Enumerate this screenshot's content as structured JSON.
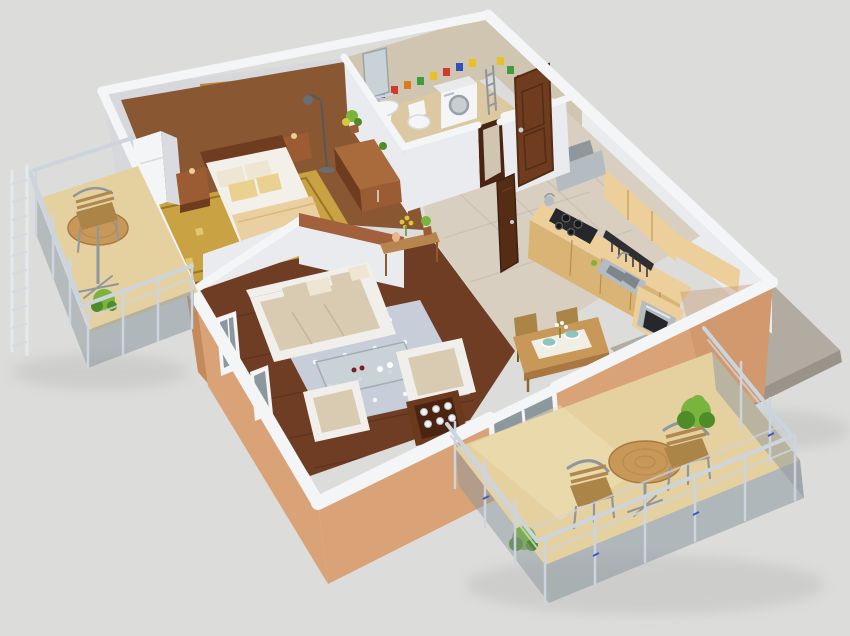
{
  "scene": {
    "type": "3d-floorplan-render",
    "view": "isometric-cutaway-apartment",
    "rooms": [
      {
        "name": "bedroom",
        "furniture": [
          "double-bed",
          "two-nightstands",
          "table-lamp",
          "floor-lamp",
          "wooden-wardrobe",
          "built-in-closet",
          "landscape-painting",
          "ornamental-gold-rug",
          "potted-plant"
        ]
      },
      {
        "name": "bathroom",
        "furniture": [
          "washbasin-with-pedestal",
          "mirror",
          "shelf",
          "toilet",
          "washing-machine",
          "towel-ladder",
          "mosaic-tile-border"
        ]
      },
      {
        "name": "hall",
        "furniture": [
          "entrance-door",
          "open-bathroom-door",
          "tile-floor"
        ]
      },
      {
        "name": "kitchen",
        "furniture": [
          "base-cabinets",
          "wall-cabinets",
          "gas-hob",
          "kettle",
          "extractor-hood",
          "double-sink",
          "utensil-rail",
          "built-in-oven",
          "counter-extension"
        ]
      },
      {
        "name": "living-room",
        "furniture": [
          "three-seat-sofa",
          "throw-pillows",
          "glass-coffee-table",
          "two-armchairs",
          "polka-dot-rug",
          "console-table",
          "flower-pots",
          "sideboard-with-glasses"
        ]
      },
      {
        "name": "dining-area",
        "furniture": [
          "dining-table",
          "table-runner",
          "two-chairs",
          "bowls",
          "flower-vase"
        ]
      },
      {
        "name": "left-balcony",
        "furniture": [
          "round-bistro-table",
          "slatted-chair",
          "potted-plant",
          "glass-metal-railing"
        ]
      },
      {
        "name": "right-balcony",
        "furniture": [
          "round-bistro-table",
          "two-slatted-chairs",
          "green-shrubs",
          "glass-metal-railing",
          "balcony-window-door"
        ]
      }
    ]
  },
  "colors": {
    "background": "#dcdddb",
    "concrete": "#b2aba2",
    "concrete_dark": "#9a9389",
    "wall_cap": "#f4f5f7",
    "wall_light": "#e9ebee",
    "wall_mid": "#d9dbe0",
    "wall_back": "#d7d8dc",
    "salmon": "#d9a277",
    "salmon_light": "#e6bd92",
    "salmon_dark": "#c48a5c",
    "bath_wall": "#cfc5b0",
    "bath_floor": "#dcc9a2",
    "tile": "#d8cfc0",
    "tile_line": "#b4aa97",
    "wood_dark": "#6e3d23",
    "wood_line": "#4f2a13",
    "bed_floor": "#8a5733",
    "rug_gold": "#c9a244",
    "rug_gold_dark": "#8d6c1d",
    "rug_blue": "#c7ced9",
    "white_soft": "#f0efec",
    "cushion": "#d9cbb2",
    "pillow_cream": "#eee6d3",
    "pillow_gold": "#ebd190",
    "linen": "#f3f0ea",
    "blanket": "#eacfa0",
    "brown": "#9b5c33",
    "brown_dark": "#6f3c1f",
    "brown_deep": "#4a2410",
    "door": "#6f3c1f",
    "door_dark": "#552c14",
    "kitchen_wood": "#eccf9a",
    "kitchen_wood_dark": "#d9b475",
    "steel": "#b4bcc2",
    "steel_dark": "#8f979e",
    "appliance_black": "#26272b",
    "fixture_white": "#f4f5f6",
    "rail": "#ccd4de",
    "rail_dark": "#9aa4b0",
    "glass": "#8d979e",
    "balcony": "#e5d1a0",
    "balcony_light": "#f0e2b4",
    "green": "#79b43d",
    "green_dark": "#4e8c28",
    "accent_blue": "#3e58c8",
    "brick": "#a2603c",
    "glass_table": "#c9d3d7",
    "mosaic_red": "#cf3a30",
    "mosaic_yellow": "#e8c224",
    "mosaic_green": "#3f9b3f",
    "mosaic_blue": "#2d52c0",
    "mosaic_orange": "#e07820",
    "painting_sky": "#6f9fd8",
    "painting_cloud": "#f3f6f9",
    "painting_field": "#5f9140",
    "painting_frame": "#b5883f",
    "teal": "#8fc3bd",
    "wood_table": "#c89858",
    "wood_table_dark": "#a87840",
    "chair_wood": "#ab8448",
    "lamp_metal": "#6a6d72",
    "yellow_plant": "#d8c83e"
  }
}
